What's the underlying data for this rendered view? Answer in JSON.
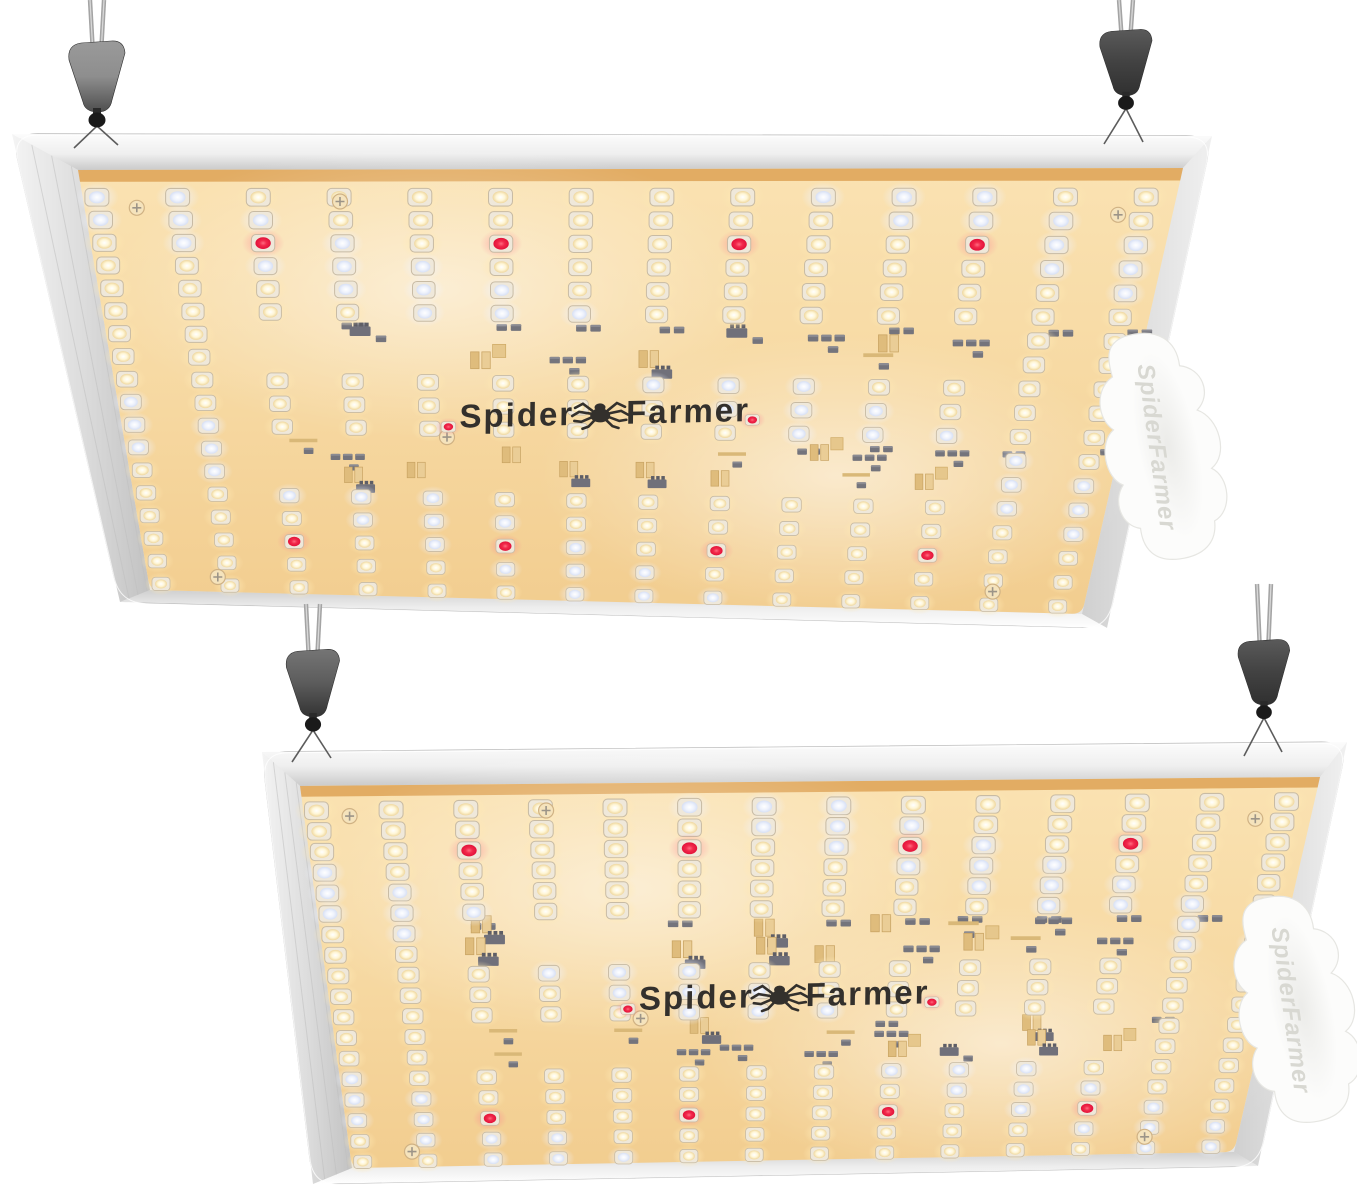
{
  "meta": {
    "description": "Product photo: two Spider Farmer quantum-board LED grow lights hanging from ratchet rope hangers, viewed from below at an angle",
    "background": "#ffffff",
    "width": 1357,
    "height": 1190
  },
  "brand": {
    "logo_part1": "Spider",
    "logo_part2": "Farmer",
    "side_label": "SpiderFarmer"
  },
  "colors": {
    "board_top": "#FAE2B2",
    "board_bottom": "#F2CD8F",
    "gold_strip": "#E0A95F",
    "frame_light": "#FCFCFC",
    "frame_dark": "#CACACA",
    "outer_stroke": "#BABABA",
    "led_package": "#EFE8DA",
    "led_package_stroke": "#C8BBA4",
    "warm_dome": "#FFF6D6",
    "cool_dome": "#D7E0F5",
    "red_dome": "#E2123A",
    "warm_halo": "#FFE9B4",
    "cool_halo": "#EFF3FF",
    "red_halo": "#FF7A8E",
    "component_dark": "#70707A",
    "component_gold": "#DFBC7C",
    "logo_text": "#33302C",
    "driver_box": "#FCFCFB",
    "driver_box_text": "#D8D8D2",
    "hanger_light": "#8E8E8E",
    "hanger_dark": "#303030",
    "cable": "#A4A4A4",
    "wire": "#5C5C5C",
    "screw_fill": "#F5E3BC",
    "screw_stroke": "#D0B284"
  },
  "led_layout": {
    "columns": 14,
    "rows": 18,
    "col_u_start": 0.013,
    "col_u_step": 0.0738,
    "row_v_start": 0.065,
    "row_v_step": 0.0541,
    "component_row_pairs": [
      [
        6,
        7
      ],
      [
        11,
        12
      ]
    ],
    "component_col_range": [
      2,
      11
    ],
    "red_leds": [
      {
        "row": 2,
        "cols": [
          2,
          5,
          8,
          11
        ]
      },
      {
        "row": 15,
        "cols": [
          2,
          5,
          8,
          11
        ]
      }
    ],
    "logo_flank_reds": {
      "dx": 152,
      "dy": 10,
      "scale": 0.62
    },
    "cool_mod": 10,
    "cool_set": [
      0,
      3,
      6
    ],
    "led_scale_near": 1.06,
    "led_scale_far": 0.78
  },
  "panels": [
    {
      "name": "panel-top",
      "frame_quad": [
        [
          12,
          134
        ],
        [
          1212,
          136
        ],
        [
          1107,
          628
        ],
        [
          120,
          602
        ]
      ],
      "board_quad": [
        [
          78,
          170
        ],
        [
          1183,
          168
        ],
        [
          1082,
          614
        ],
        [
          150,
          590
        ]
      ],
      "logo": {
        "u": 0.478,
        "v": 0.565,
        "tilt": -1.3
      },
      "driver_box": {
        "cx": 1158,
        "cy": 447,
        "rot": -12
      },
      "screws": [
        [
          0.048,
          0.09
        ],
        [
          0.95,
          0.105
        ],
        [
          0.325,
          0.625
        ],
        [
          0.9,
          0.955
        ],
        [
          0.075,
          0.965
        ],
        [
          0.235,
          0.075
        ]
      ],
      "hangers": [
        {
          "cx": 97,
          "cable_top": 0,
          "body_top": 48,
          "s": 1.0,
          "tone": "light",
          "attach": [
            [
              74,
              148
            ],
            [
              118,
              145
            ]
          ]
        },
        {
          "cx": 1126,
          "cable_top": 0,
          "body_top": 36,
          "s": 0.93,
          "tone": "dark",
          "attach": [
            [
              1104,
              144
            ],
            [
              1143,
              142
            ]
          ]
        }
      ],
      "seed": 3
    },
    {
      "name": "panel-bottom",
      "frame_quad": [
        [
          262,
          752
        ],
        [
          1347,
          742
        ],
        [
          1258,
          1166
        ],
        [
          313,
          1184
        ]
      ],
      "board_quad": [
        [
          300,
          786
        ],
        [
          1320,
          777
        ],
        [
          1234,
          1152
        ],
        [
          352,
          1168
        ]
      ],
      "logo": {
        "u": 0.478,
        "v": 0.565,
        "tilt": -1.3
      },
      "driver_box": {
        "cx": 1292,
        "cy": 1010,
        "rot": -12
      },
      "screws": [
        [
          0.045,
          0.08
        ],
        [
          0.945,
          0.11
        ],
        [
          0.33,
          0.62
        ],
        [
          0.895,
          0.955
        ],
        [
          0.07,
          0.96
        ],
        [
          0.24,
          0.07
        ]
      ],
      "hangers": [
        {
          "cx": 313,
          "cable_top": 604,
          "body_top": 656,
          "s": 0.95,
          "tone": "mid",
          "attach": [
            [
              292,
              762
            ],
            [
              331,
              758
            ]
          ]
        },
        {
          "cx": 1264,
          "cable_top": 584,
          "body_top": 646,
          "s": 0.92,
          "tone": "dark",
          "attach": [
            [
              1244,
              756
            ],
            [
              1282,
              752
            ]
          ]
        }
      ],
      "seed": 11
    }
  ]
}
